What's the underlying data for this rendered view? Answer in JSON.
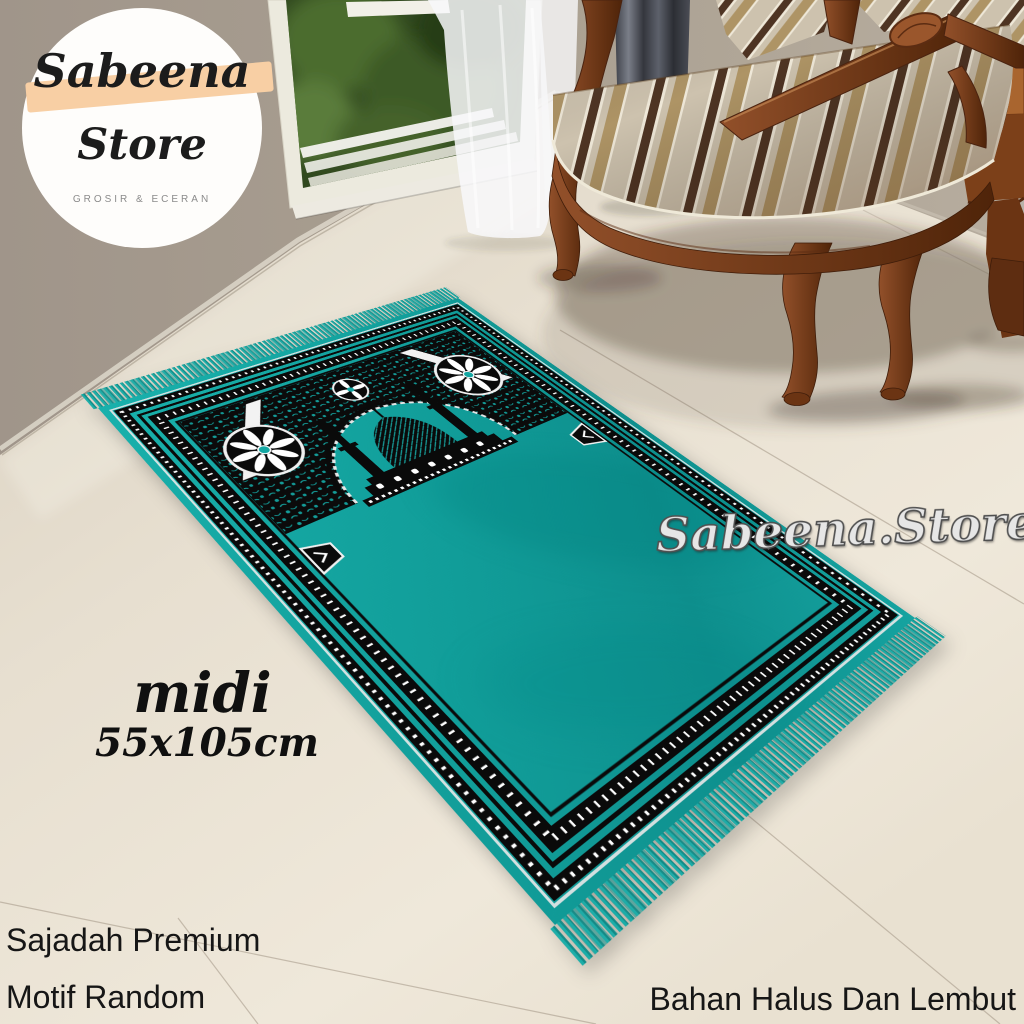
{
  "badge": {
    "brand_line1": "Sabeena",
    "brand_line2": "Store",
    "tagline": "GROSIR & ECERAN"
  },
  "watermark": "Sabeena.Store",
  "size_label": {
    "size_name": "midi",
    "dimensions": "55x105cm"
  },
  "captions": {
    "left_line1": "Sajadah Premium",
    "left_line2": "Motif Random",
    "bottom_right": "Bahan Halus Dan Lembut"
  },
  "colors": {
    "rug_teal": "#14a7a3",
    "rug_teal_dark": "#0d8d8b",
    "motif_black": "#0b0b0b",
    "motif_white": "#f2f2f2",
    "badge_highlight": "#f8cfa4",
    "wall_taupe": "#a89d90",
    "floor_cream": "#e8dfd1",
    "wood_brown": "#8a4a26",
    "stripe_brown": "#4e3423",
    "stripe_tan": "#ae9465",
    "curtain_gray": "#4a4d55"
  }
}
